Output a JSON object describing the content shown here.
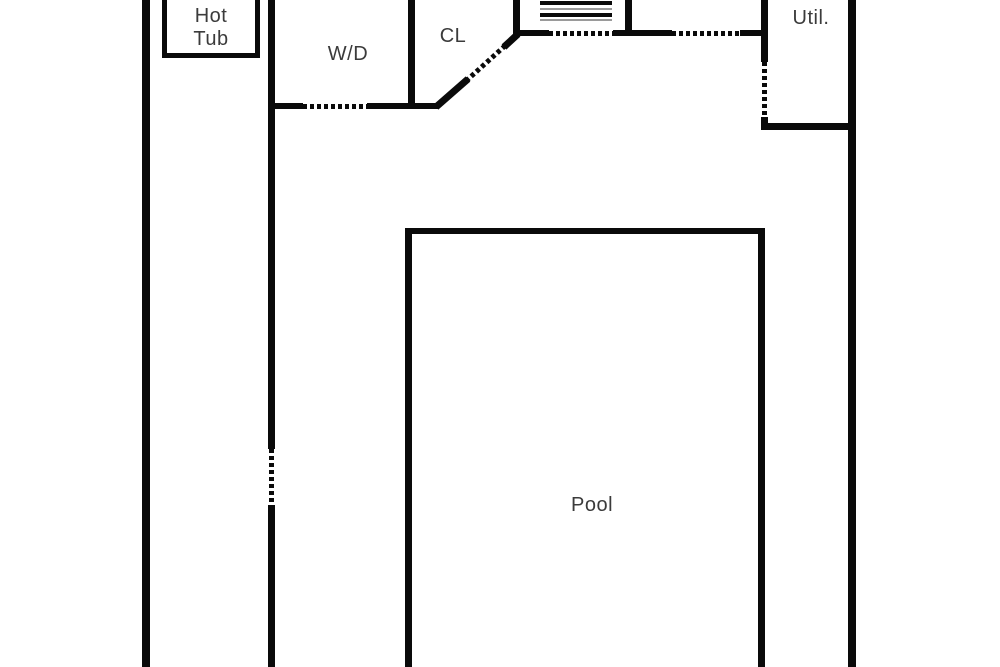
{
  "plan_title": "floor-plan",
  "colors": {
    "wall": "#0a0a0a",
    "text": "#3b3b3b",
    "background": "#ffffff"
  },
  "rooms": {
    "hot_tub": {
      "line1": "Hot",
      "line2": "Tub"
    },
    "laundry": {
      "label": "W/D"
    },
    "closet": {
      "label": "CL"
    },
    "utility": {
      "label": "Util."
    },
    "pool": {
      "label": "Pool"
    }
  },
  "symbols": {
    "door_openings": 6,
    "shelf_lines": 2
  }
}
